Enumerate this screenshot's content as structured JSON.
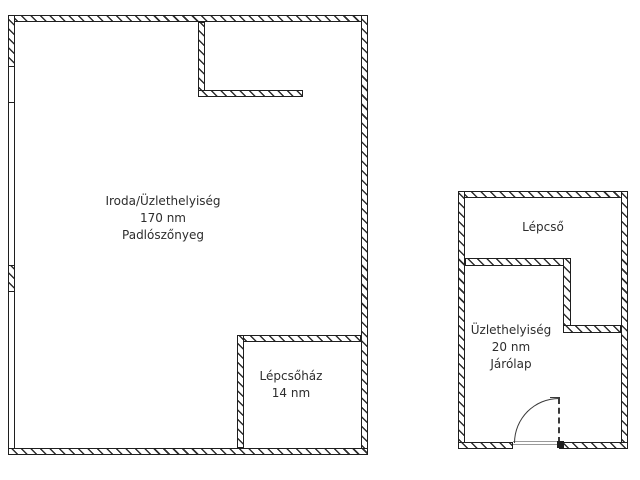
{
  "background": "#ffffff",
  "colors": {
    "background": "#ffffff",
    "wall_line": "#1f1f1f",
    "hatch": "#2e2e2e",
    "text": "#2d2d2d",
    "door": "#3a3a3a",
    "threshold": "#9a9a9a"
  },
  "plan_left": {
    "room_main": {
      "name": "Iroda/Üzlethelyiség",
      "area": "170 nm",
      "floor": "Padlószőnyeg"
    },
    "room_stairwell": {
      "name": "Lépcsőház",
      "area": "14 nm"
    }
  },
  "plan_right": {
    "room_stairs": {
      "name": "Lépcső"
    },
    "room_shop": {
      "name": "Üzlethelyiség",
      "area": "20 nm",
      "floor": "Járólap"
    }
  }
}
